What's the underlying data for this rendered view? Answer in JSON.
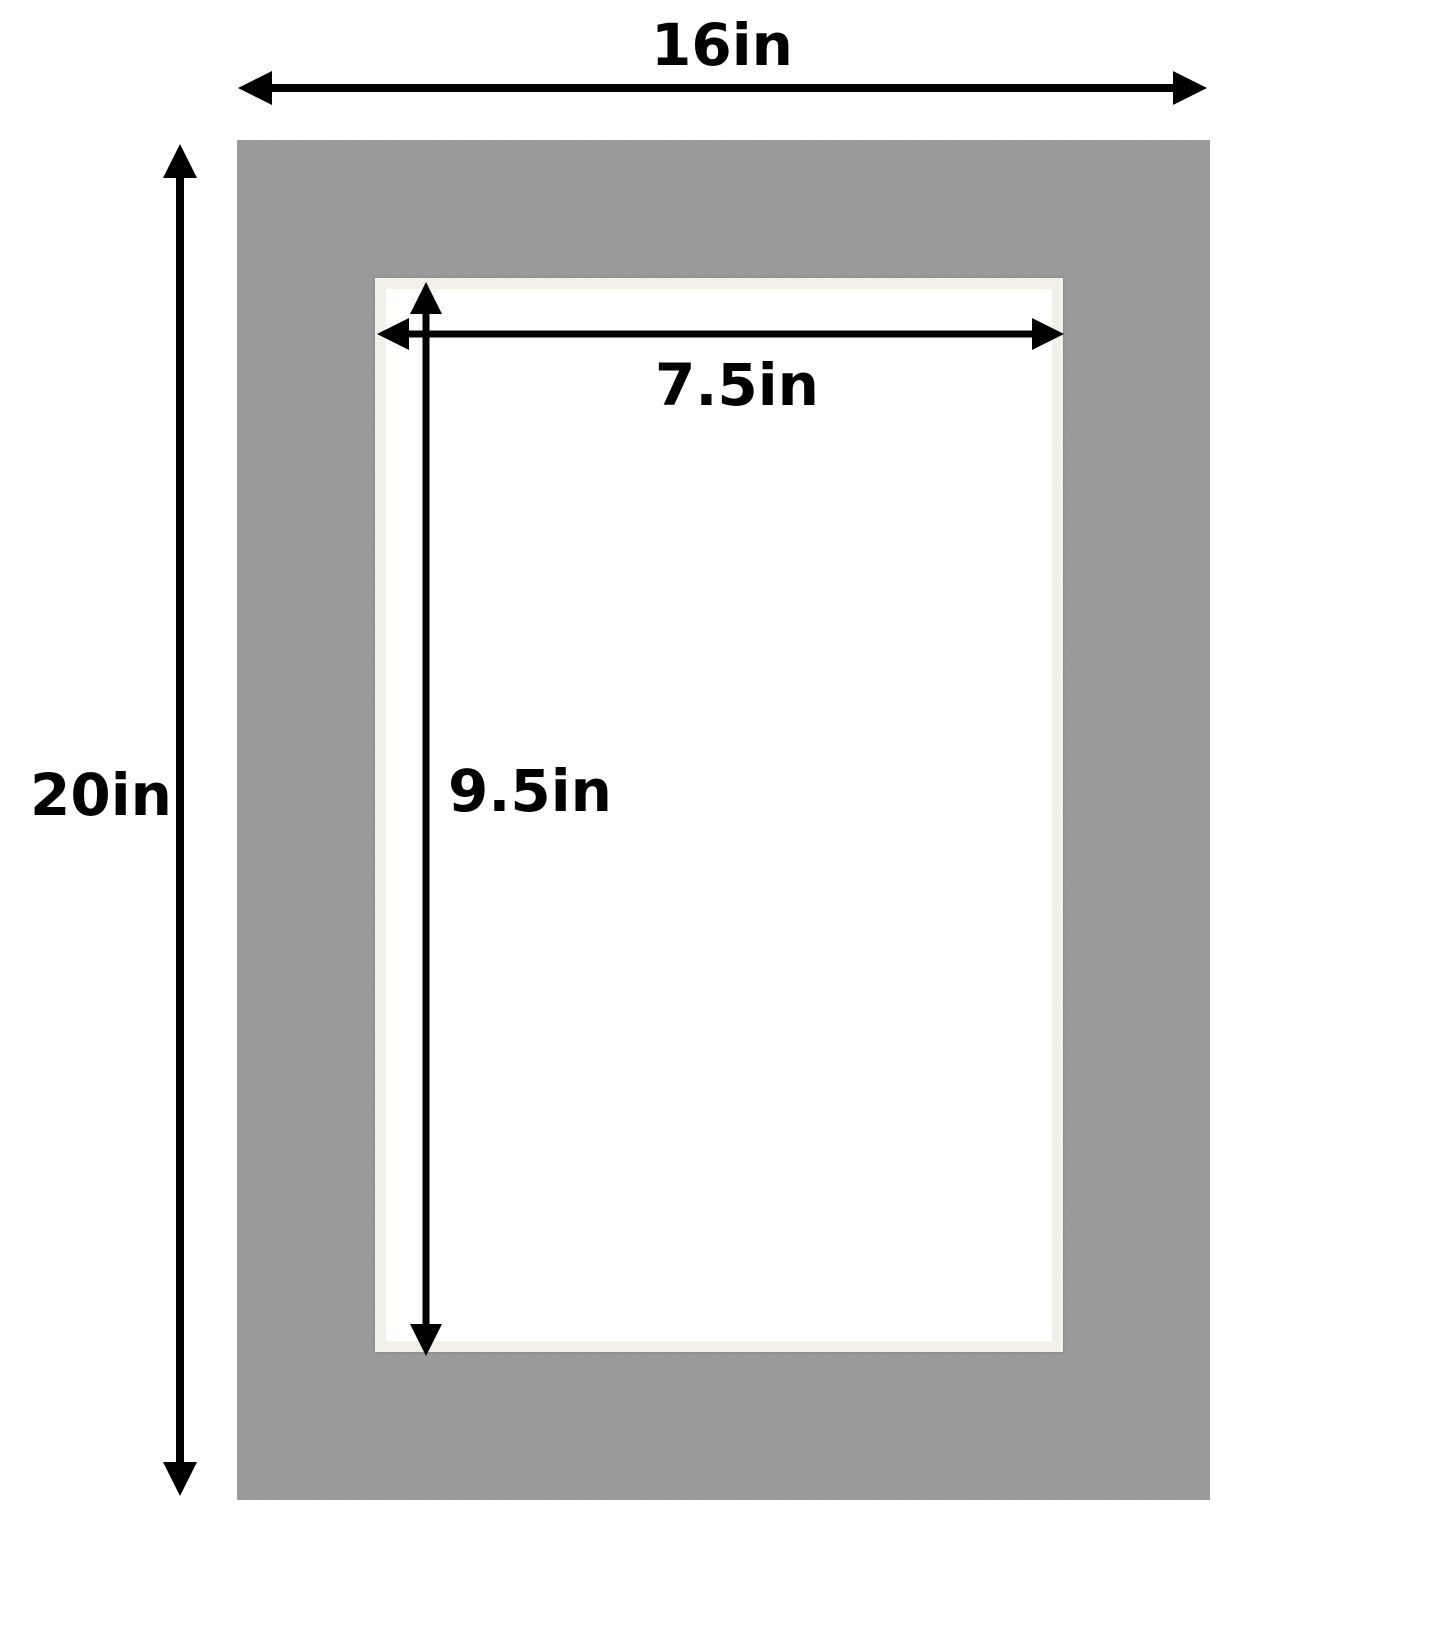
{
  "labels": {
    "outer_width": "16in",
    "outer_height": "20in",
    "opening_width": "7.5in",
    "opening_height": "9.5in"
  },
  "colors": {
    "background": "#ffffff",
    "mat": "#9a9a9a",
    "bevel": "#f2f0e7",
    "opening": "#ffffff",
    "dimension": "#000000"
  }
}
